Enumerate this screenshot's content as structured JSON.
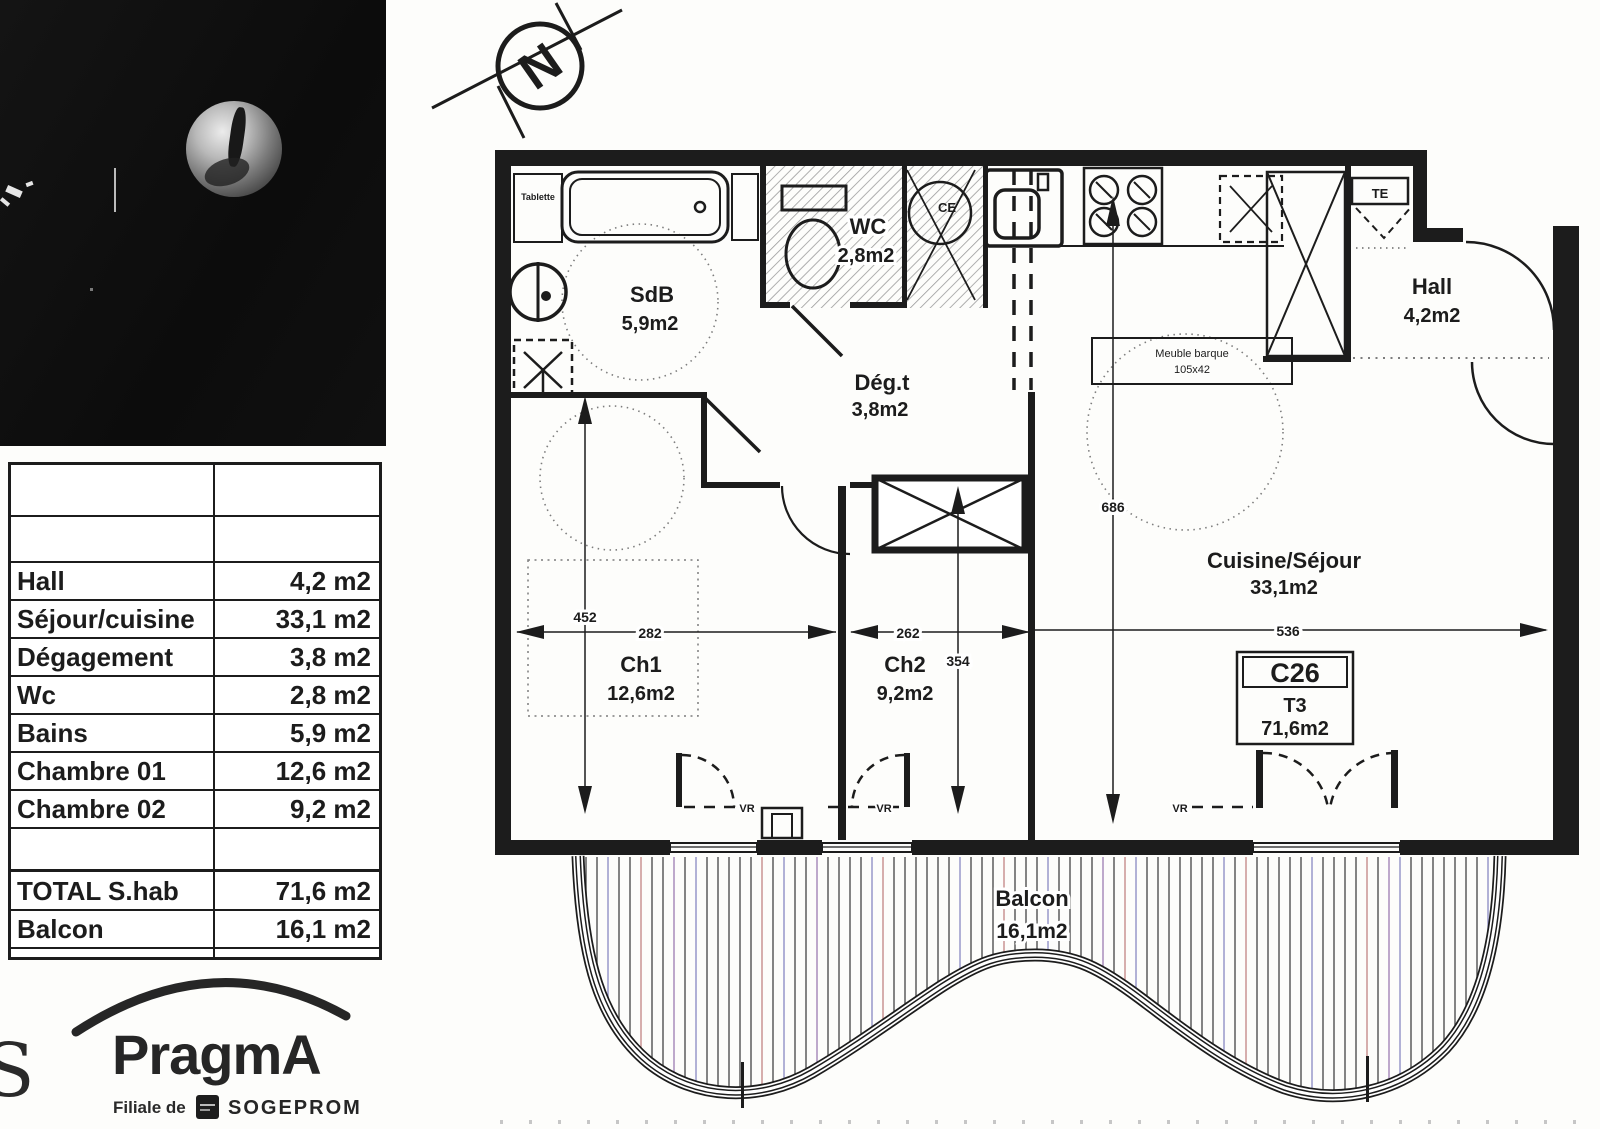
{
  "scan": {
    "compass_letter": "N",
    "table": {
      "rows": [
        {
          "label": "",
          "value": ""
        },
        {
          "label": "",
          "value": ""
        },
        {
          "label": "Hall",
          "value": "4,2 m2"
        },
        {
          "label": "Séjour/cuisine",
          "value": "33,1 m2"
        },
        {
          "label": "Dégagement",
          "value": "3,8 m2"
        },
        {
          "label": "Wc",
          "value": "2,8 m2"
        },
        {
          "label": "Bains",
          "value": "5,9 m2"
        },
        {
          "label": "Chambre 01",
          "value": "12,6 m2"
        },
        {
          "label": "Chambre 02",
          "value": "9,2 m2"
        },
        {
          "label": "",
          "value": ""
        },
        {
          "label": "TOTAL S.hab",
          "value": "71,6 m2"
        },
        {
          "label": "Balcon",
          "value": "16,1 m2"
        }
      ]
    },
    "logo": {
      "partial_letter": "S",
      "brand": "PragmA",
      "filiale": "Filiale de",
      "parent": "SOGEPROM"
    },
    "plan": {
      "rooms": {
        "sdb": {
          "name": "SdB",
          "area": "5,9m2"
        },
        "wc": {
          "name": "WC",
          "area": "2,8m2"
        },
        "deg": {
          "name": "Dég.t",
          "area": "3,8m2"
        },
        "hall": {
          "name": "Hall",
          "area": "4,2m2"
        },
        "ch1": {
          "name": "Ch1",
          "area": "12,6m2"
        },
        "ch2": {
          "name": "Ch2",
          "area": "9,2m2"
        },
        "sejour": {
          "name": "Cuisine/Séjour",
          "area": "33,1m2"
        },
        "balcon": {
          "name": "Balcon",
          "area": "16,1m2"
        }
      },
      "unit": {
        "code": "C26",
        "type": "T3",
        "area": "71,6m2"
      },
      "dims": {
        "ch1_w": "282",
        "ch1_h": "452",
        "ch2_w": "262",
        "ch2_h": "354",
        "sej_w": "536",
        "sej_h": "686"
      },
      "annotations": {
        "tablette": "Tablette",
        "ce": "CE",
        "te": "TE",
        "vr": "VR",
        "meuble_line1": "Meuble barque",
        "meuble_line2": "105x42"
      },
      "ink_color": "#1c1c1c",
      "hatch_color": "#9b9b9b"
    }
  }
}
